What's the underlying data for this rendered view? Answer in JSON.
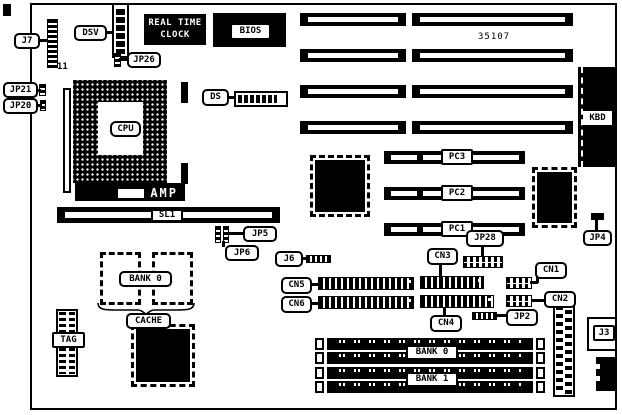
{
  "figure": {
    "type": "motherboard-component-location-diagram",
    "ink_color": "#000000",
    "paper_color": "#ffffff",
    "board_number": "35107"
  },
  "labels": {
    "j7": "J7",
    "j7_pin_count": "11",
    "dsv": "DSV",
    "rtc_line1": "REAL TIME",
    "rtc_line2": "CLOCK",
    "jp26": "JP26",
    "bios": "BIOS",
    "board_number": "35107",
    "jp21": "JP21",
    "jp20": "JP20",
    "cpu": "CPU",
    "ds": "DS",
    "kbd": "KBD",
    "amp": "AMP",
    "sl1": "SL1",
    "jp5": "JP5",
    "jp6": "JP6",
    "j6": "J6",
    "pc3": "PC3",
    "pc2": "PC2",
    "pc1": "PC1",
    "jp28": "JP28",
    "jp4": "JP4",
    "cache_bank0": "BANK 0",
    "cache": "CACHE",
    "tag": "TAG",
    "cn3": "CN3",
    "cn5": "CN5",
    "cn6": "CN6",
    "cn4": "CN4",
    "cn1": "CN1",
    "cn2": "CN2",
    "jp2": "JP2",
    "simm_bank0": "BANK 0",
    "simm_bank1": "BANK 1",
    "j3": "J3"
  }
}
